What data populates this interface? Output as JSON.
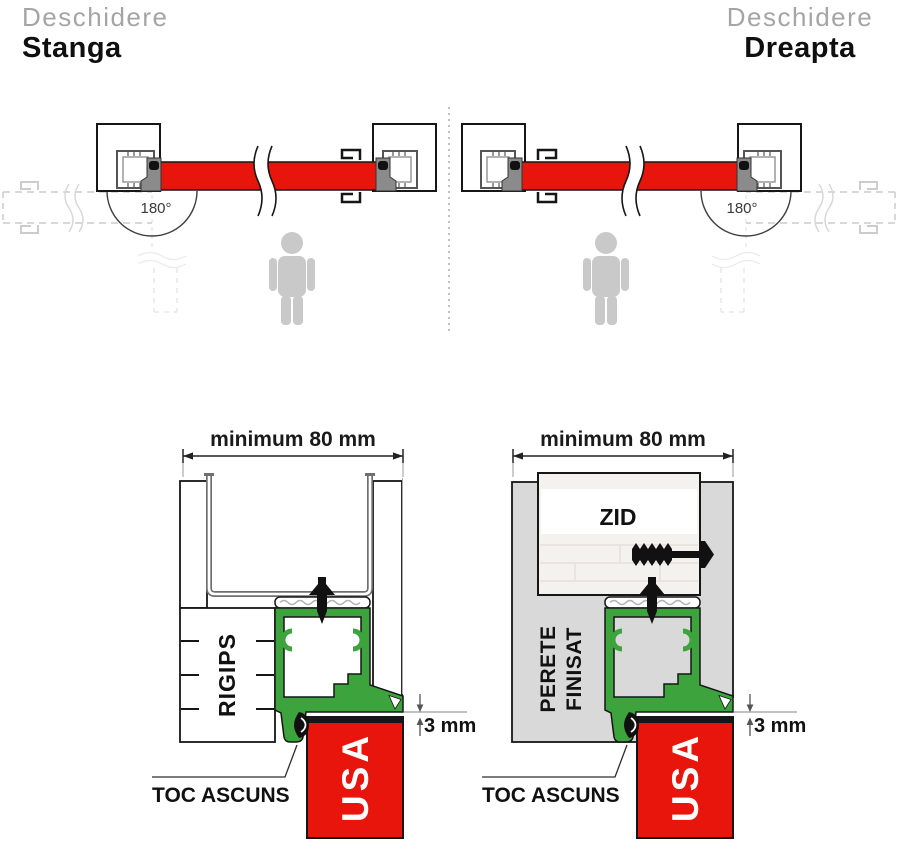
{
  "header_left": {
    "line1": "Deschidere",
    "line2": "Stanga"
  },
  "header_right": {
    "line1": "Deschidere",
    "line2": "Dreapta"
  },
  "plan_left": {
    "angle": "180°"
  },
  "plan_right": {
    "angle": "180°"
  },
  "section_left": {
    "dim": "minimum 80 mm",
    "wall": "RIGIPS",
    "frame": "TOC ASCUNS",
    "door": "USA",
    "gap": "3 mm"
  },
  "section_right": {
    "dim": "minimum 80 mm",
    "wall1": "PERETE",
    "wall2": "FINISAT",
    "masonry": "ZID",
    "frame": "TOC ASCUNS",
    "door": "USA",
    "gap": "3 mm"
  },
  "colors": {
    "door_red": "#e8150d",
    "frame_green": "#3da33c",
    "wall_gray": "#d9d9d9",
    "silhouette_gray": "#c9c9c9"
  }
}
